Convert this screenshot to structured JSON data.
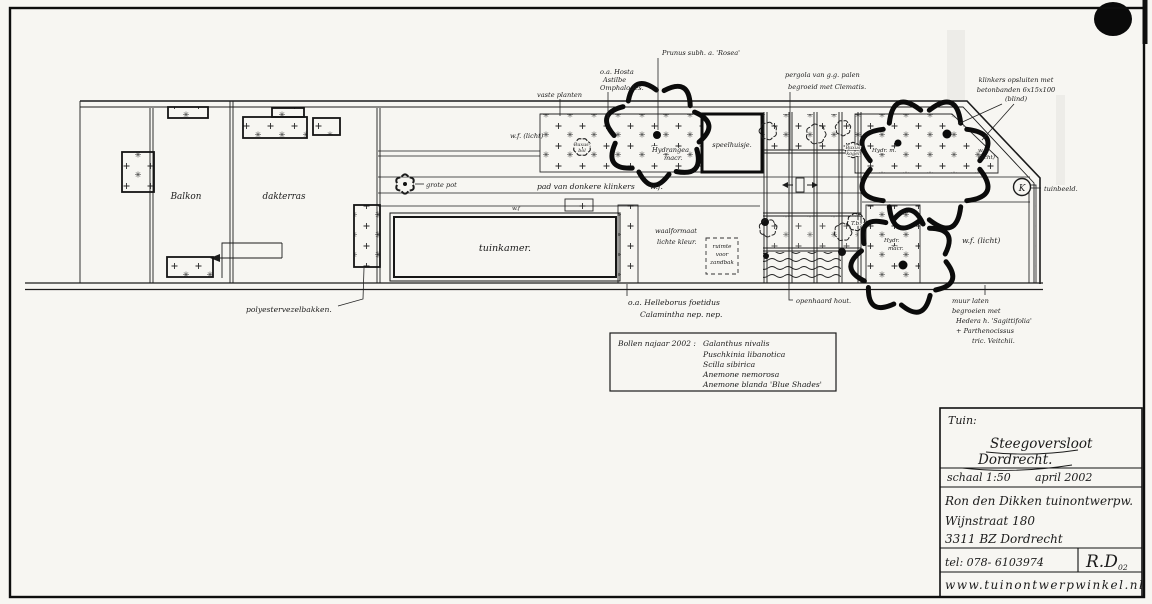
{
  "plan": {
    "balkon": "Balkon",
    "dakterras": "dakterras",
    "tuinkamer": "tuinkamer.",
    "grote_pot": "grote pot",
    "polyester_bakken": "polyestervezelbakken.",
    "vaste_planten": "vaste planten",
    "hosta": [
      "o.a. Hosta",
      "Astilbe",
      "Omphalodes."
    ],
    "prunus": "Prunus subh. a. 'Rosea'",
    "wf_licht_left": "w.f. (licht)",
    "buxus_bol": [
      "Buxus-",
      "bol"
    ],
    "hydrangea_macr": [
      "Hydrangea",
      "macr."
    ],
    "pad": "pad van donkere klinkers",
    "wf_pad": "w.f.",
    "wf_top": "w.f",
    "waalformaat": [
      "waalformaat",
      "lichte kleur."
    ],
    "zandbak": [
      "ruimte",
      "voor",
      "zandbak"
    ],
    "helleborus": [
      "o.a. Helleborus foetidus",
      "Calamintha nep. nep."
    ],
    "speelhuisje": "speelhuisje.",
    "pergola": [
      "pergola van g.g. palen",
      "begroeid met Clematis."
    ],
    "openhaard": "openhaard hout.",
    "klinkers": [
      "klinkers opsluiten met",
      "betonbanden 6x15x100",
      "(blind)"
    ],
    "buxus_kogel": [
      "Buxus",
      "kogel"
    ],
    "hydr_m": "Hydr. m.",
    "wf_licht_klein": [
      "w.f.",
      "(licht)"
    ],
    "tb": "T.b.",
    "hydr_macr": [
      "Hydr.",
      "macr."
    ],
    "wf_licht_rechts": "w.f. (licht)",
    "k_marker": "K",
    "tuinbeeld": "tuinbeeld.",
    "muur": [
      "muur laten",
      "begroeien met",
      "Hedera h. 'Sagittifolia'",
      "+ Parthenocissus",
      "tric. Veitchii."
    ]
  },
  "bulb_list": {
    "title": "Bollen najaar 2002 :",
    "items": [
      "Galanthus nivalis",
      "Puschkinia libanotica",
      "Scilla sibirica",
      "Anemone nemorosa",
      "Anemone blanda 'Blue Shades'"
    ]
  },
  "title_block": {
    "tuin_label": "Tuin:",
    "project_name": "Steegoversloot",
    "project_city": "Dordrecht.",
    "scale": "schaal 1:50",
    "date": "april 2002",
    "designer": "Ron den Dikken tuinontwerpw.",
    "address_street": "Wijnstraat 180",
    "address_city": "3311 BZ Dordrecht",
    "phone": "tel: 078- 6103974",
    "monogram": "R.D",
    "monogram_year": "02",
    "website": "www.tuinontwerpwinkel.nl"
  }
}
